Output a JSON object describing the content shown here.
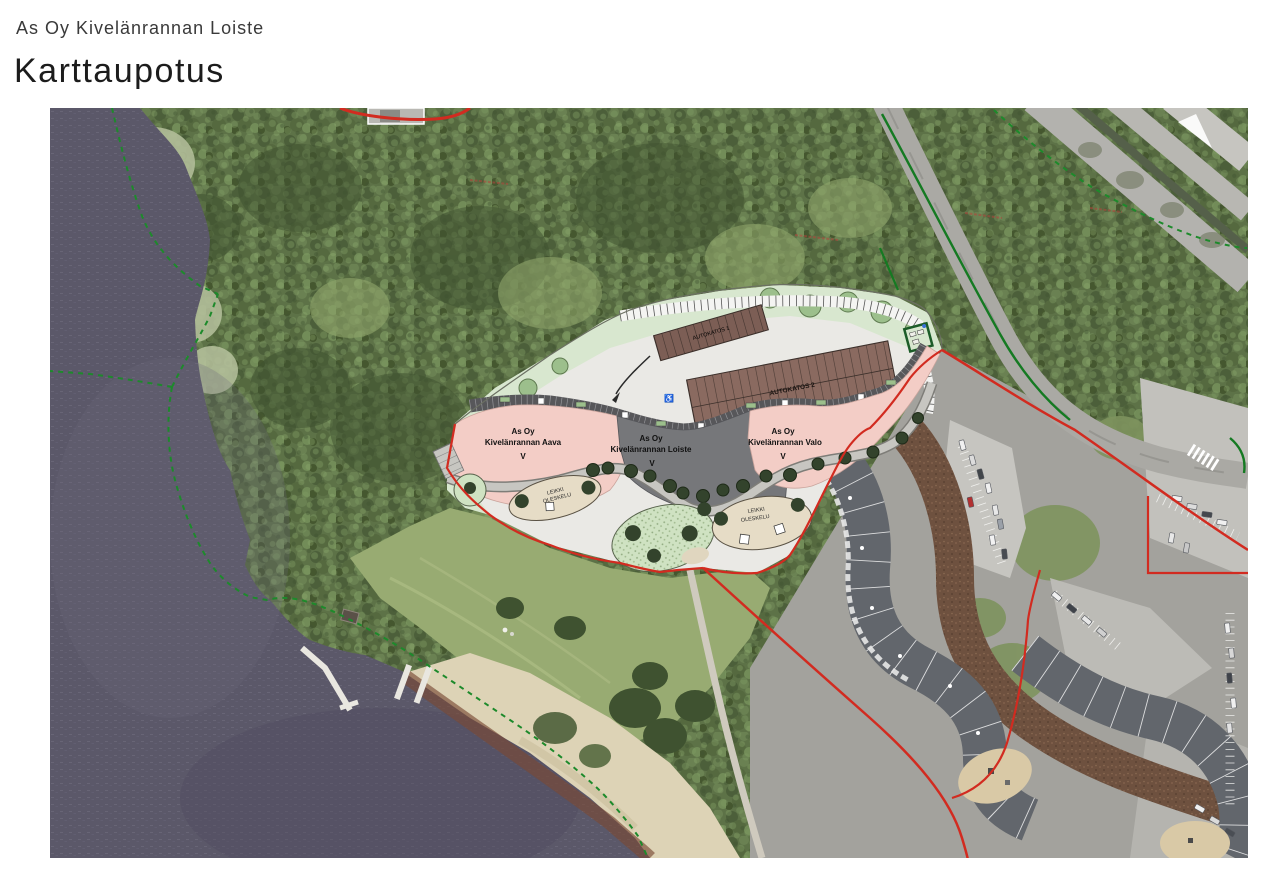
{
  "page": {
    "subtitle": "As Oy Kivelänrannan Loiste",
    "title": "Karttaupotus"
  },
  "map": {
    "description": "Aerial photo with architectural site plan overlay, lake shore, forest, roads and neighbouring housing",
    "labels": {
      "aava": {
        "l1": "As Oy",
        "l2": "Kivelänrannan Aava",
        "l3": "V"
      },
      "loiste": {
        "l1": "As Oy",
        "l2": "Kivelänrannan Loiste",
        "l3": "V"
      },
      "valo": {
        "l1": "As Oy",
        "l2": "Kivelänrannan Valo",
        "l3": "V"
      },
      "carport1": "AUTOKATOS 1",
      "carport2": "AUTOKATOS 2",
      "play_left": {
        "l1": "LEIKKI",
        "l2": "OLESKELU"
      },
      "play_right": {
        "l1": "LEIKKI",
        "l2": "OLESKELU"
      }
    },
    "icons": {
      "disabled_parking": "♿"
    },
    "colors": {
      "water": "#5b5869",
      "forest": "#5d7247",
      "plan_background": "#eae9e5",
      "building_pink": "#f3cdc6",
      "building_gray": "#76777a",
      "carport_brown": "#8a6a60",
      "plan_green": "#d8e7cf",
      "boundary_red": "#d22b20",
      "boundary_green": "#1d8a2b",
      "beach_sand": "#ddd3b6"
    }
  }
}
